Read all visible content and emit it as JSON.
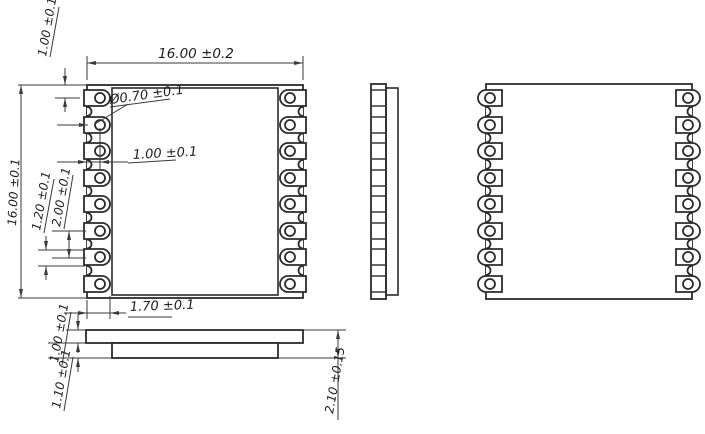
{
  "drawing_title": "castellated RF module package outline drawing",
  "colors": {
    "line": "#2b2b2b",
    "thin_line": "#3a3a3a",
    "background": "#ffffff"
  },
  "dimensions": {
    "top_width": "16.00 ±0.2",
    "top_pad_offset": "1.00 ±0.1",
    "hole_diameter": "Ø0.70 ±0.1",
    "edge_to_hole_center": "1.00 ±0.1",
    "left_height": "16.00 ±0.1",
    "pad_width": "1.20 ±0.1",
    "pad_pitch": "2.00 ±0.1",
    "pad_length": "1.70 ±0.1",
    "top_layer_thickness": "1.00 ±0.1",
    "bottom_layer_thickness": "1.10 ±0.1",
    "total_thickness": "2.10 ±0.15"
  },
  "pads_per_side": 8
}
